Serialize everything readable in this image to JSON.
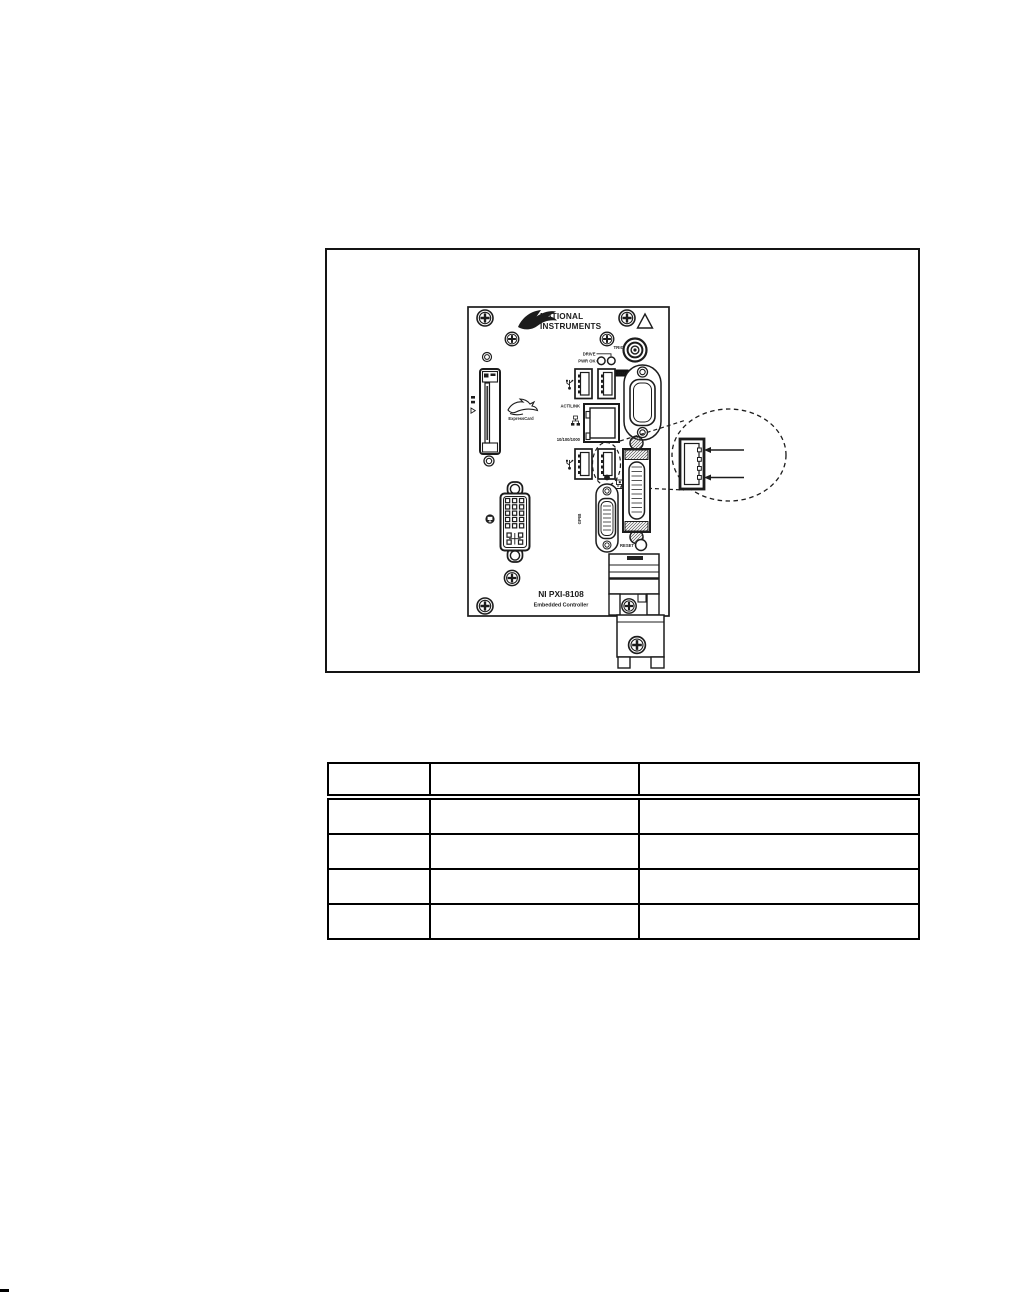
{
  "figure": {
    "brand": {
      "line1": "NATIONAL",
      "line2": "INSTRUMENTS"
    },
    "labels": {
      "trig": "TRIG",
      "drive": "DRIVE",
      "pwr_ok": "PWR OK",
      "com1": "COM1",
      "act_link": "ACT/LINK",
      "eth_speed": "10/100/1000",
      "gpib": "GPIB",
      "reset": "RESET",
      "expresscard": "ExpressCard",
      "model": "NI PXI-8108",
      "model_sub": "Embedded Controller"
    }
  },
  "table": {
    "header": [
      "",
      "",
      ""
    ],
    "rows": [
      [
        "",
        "",
        ""
      ],
      [
        "",
        "",
        ""
      ],
      [
        "",
        "",
        ""
      ],
      [
        "",
        "",
        ""
      ]
    ]
  },
  "colors": {
    "ink": "#1c1c1c",
    "paper": "#ffffff"
  }
}
